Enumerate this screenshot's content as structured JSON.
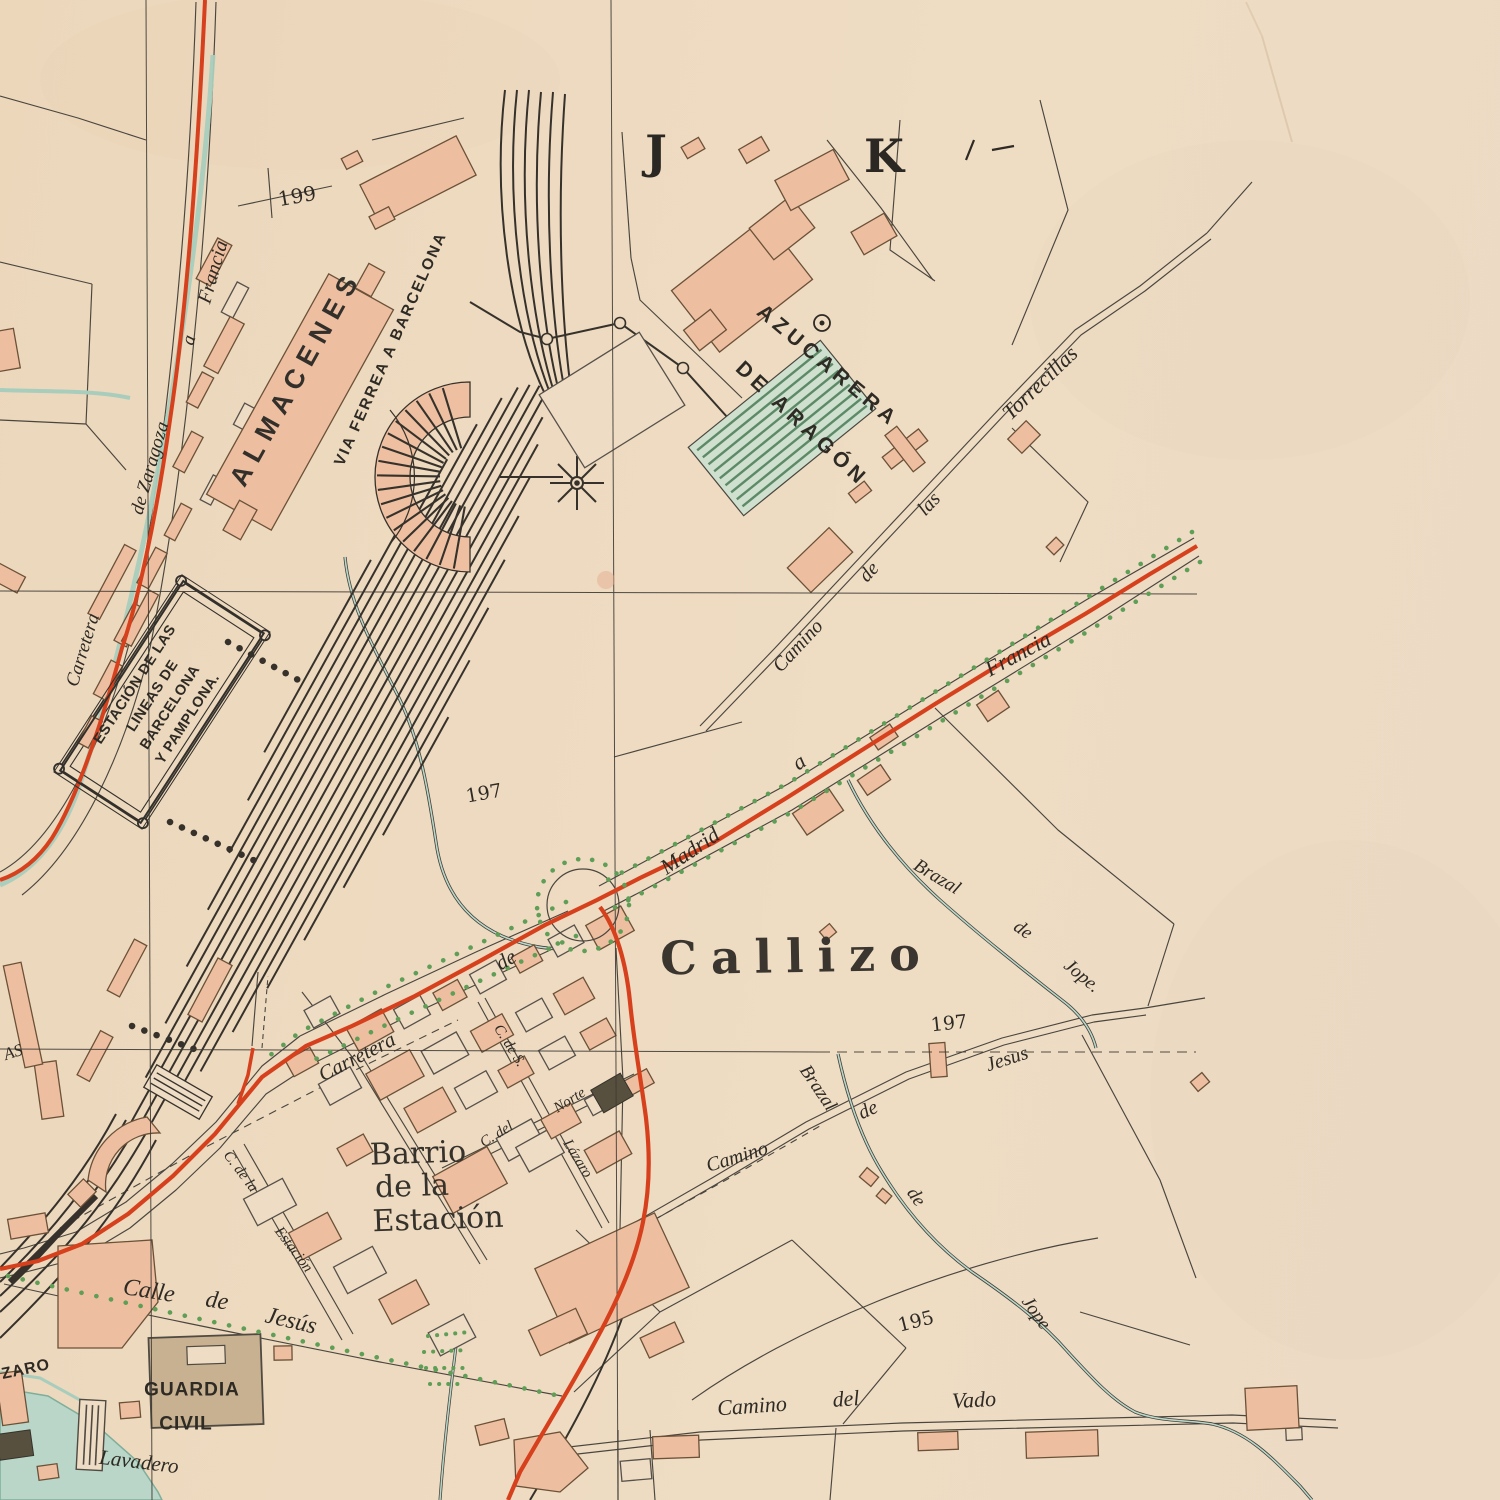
{
  "map": {
    "type": "vintage-city-plan",
    "colors": {
      "paper": "#edd9bf",
      "ink": "#2e2a24",
      "building_fill": "#edbfa0",
      "road_red": "#d6401c",
      "water_teal": "#a9cdbd",
      "tree_green": "#5f9e57",
      "shed_green": "#cfe0cf"
    },
    "grid": {
      "letters": [
        "J",
        "K"
      ]
    },
    "elevations": [
      "199",
      "197",
      "197",
      "195"
    ]
  },
  "labels": {
    "grid_j": {
      "text": "J"
    },
    "grid_k": {
      "text": "K"
    },
    "elev_199": {
      "text": "199"
    },
    "almacenes": {
      "text": "ALMACENES"
    },
    "via_ferrea": {
      "text": "VIA  FERREA  A  BARCELONA"
    },
    "zar1": {
      "text": "Carretera"
    },
    "zar2": {
      "text": "de Zaragoza"
    },
    "zar3": {
      "text": "a"
    },
    "zar4": {
      "text": "Francia"
    },
    "est_l1": {
      "text": "ESTACIÓN DE LAS"
    },
    "est_l2": {
      "text": "LINEAS DE"
    },
    "est_l3": {
      "text": "BARCELONA"
    },
    "est_l4": {
      "text": "Y PAMPLONA."
    },
    "azu_l1": {
      "text": "AZUCARERA"
    },
    "azu_l2": {
      "text": "DE ARAGÓN"
    },
    "torrecillas": {
      "text": "Torrecillas"
    },
    "cam_las_1": {
      "text": "Camino"
    },
    "cam_las_2": {
      "text": "de"
    },
    "cam_las_3": {
      "text": "las"
    },
    "mad1": {
      "text": "Carretera"
    },
    "mad2": {
      "text": "de"
    },
    "mad3": {
      "text": "Madrid"
    },
    "mad4": {
      "text": "a"
    },
    "mad5": {
      "text": "Francia"
    },
    "callizo": {
      "text": "Callizo"
    },
    "bju1": {
      "text": "Brazal"
    },
    "bju2": {
      "text": "de"
    },
    "bju3": {
      "text": "Jope."
    },
    "e197a": {
      "text": "197"
    },
    "e197b": {
      "text": "197"
    },
    "cj1": {
      "text": "Camino"
    },
    "cj2": {
      "text": "de"
    },
    "cj3": {
      "text": "Jesus"
    },
    "bjl1": {
      "text": "Brazal"
    },
    "bjl2": {
      "text": "de"
    },
    "bjl3": {
      "text": "Jope"
    },
    "cv1": {
      "text": "Camino"
    },
    "cv2": {
      "text": "del"
    },
    "cv3": {
      "text": "Vado"
    },
    "e195": {
      "text": "195"
    },
    "barrio1": {
      "text": "Barrio"
    },
    "barrio2": {
      "text": "de la"
    },
    "barrio3": {
      "text": "Estación"
    },
    "norte1": {
      "text": "C. del"
    },
    "norte2": {
      "text": "Norte"
    },
    "laz1": {
      "text": "C. de S."
    },
    "laz2": {
      "text": "Lázaro"
    },
    "cest1": {
      "text": "C. de la"
    },
    "cest2": {
      "text": "Estación"
    },
    "cjs1": {
      "text": "Calle"
    },
    "cjs2": {
      "text": "de"
    },
    "cjs3": {
      "text": "Jesús"
    },
    "gc1": {
      "text": "GUARDIA"
    },
    "gc2": {
      "text": "CIVIL"
    },
    "lavadero": {
      "text": "Lavadero"
    },
    "zaro": {
      "text": "ZARO"
    },
    "as_frag": {
      "text": "AS"
    }
  }
}
